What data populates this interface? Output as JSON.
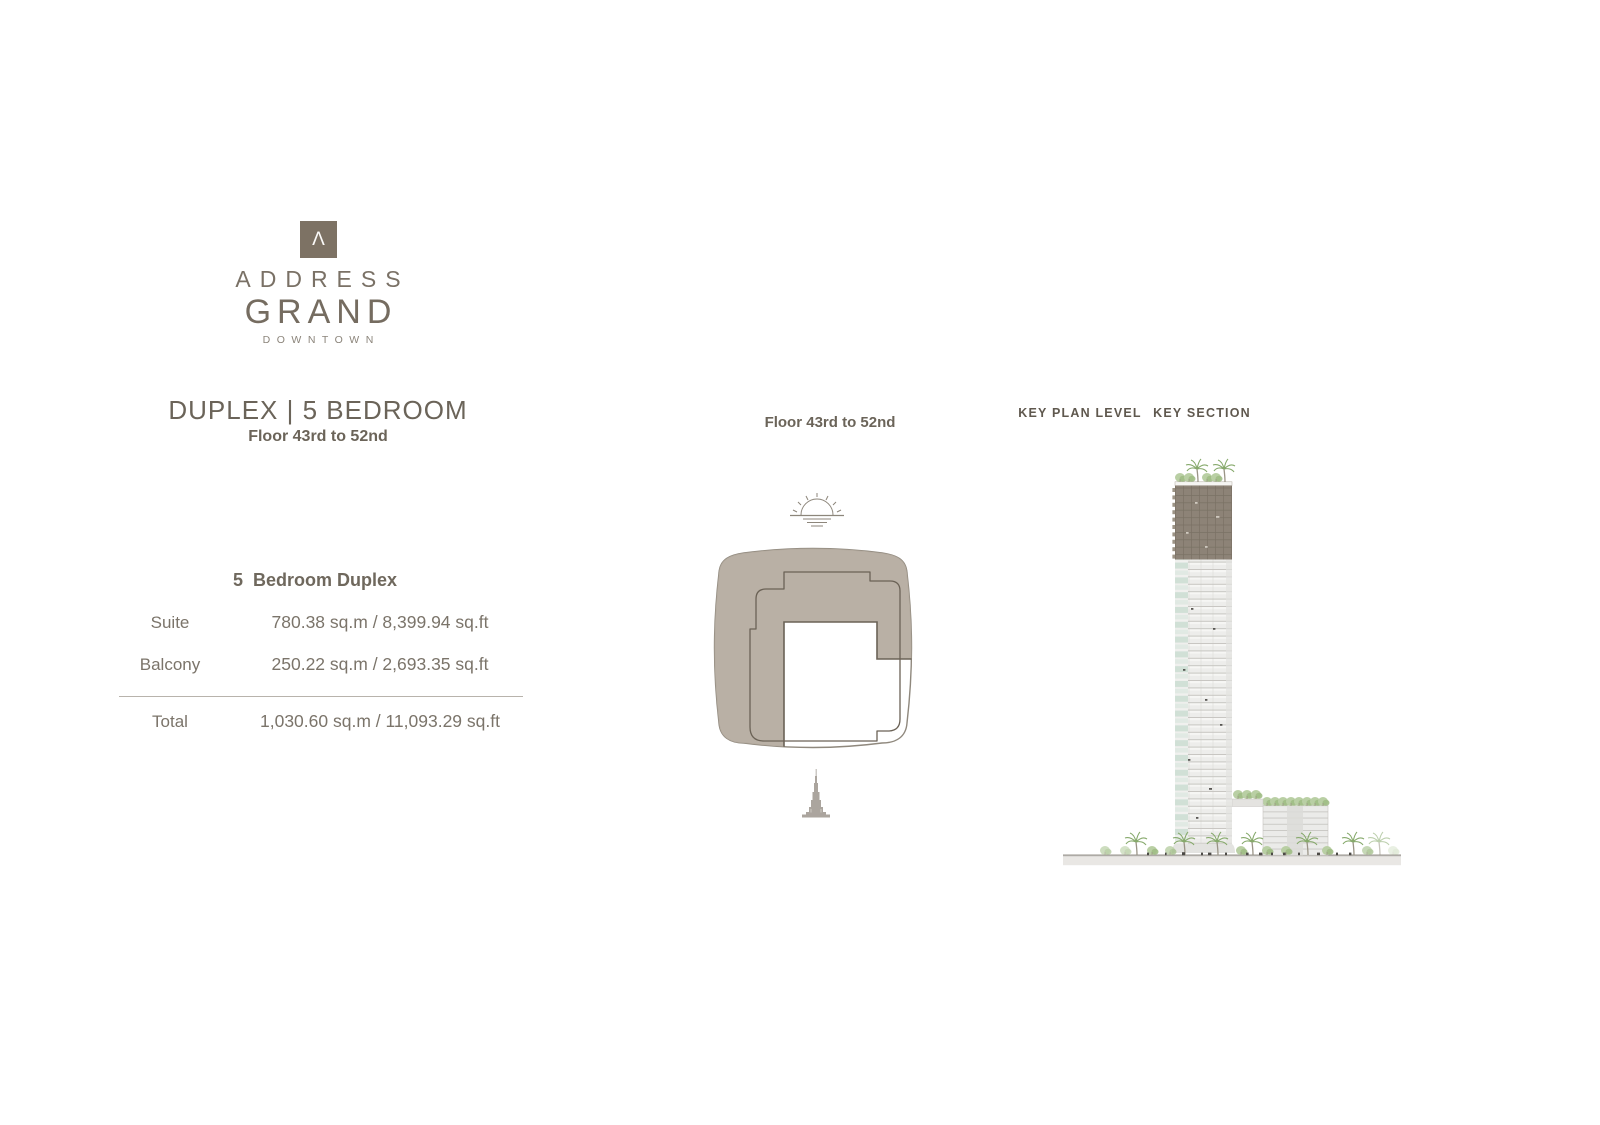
{
  "brand": {
    "mark": "Λ",
    "name_line1": "ADDRESS",
    "name_line2": "GRAND",
    "name_line3": "DOWNTOWN",
    "logo_bg": "#7d7264"
  },
  "unit": {
    "title": "DUPLEX | 5 BEDROOM",
    "floors": "Floor 43rd to 52nd"
  },
  "area_table": {
    "title": "5  Bedroom Duplex",
    "rows": [
      {
        "label": "Suite",
        "value": "780.38 sq.m / 8,399.94 sq.ft"
      },
      {
        "label": "Balcony",
        "value": "250.22 sq.m / 2,693.35 sq.ft"
      }
    ],
    "total": {
      "label": "Total",
      "value": "1,030.60 sq.m / 11,093.29 sq.ft"
    }
  },
  "key_plan": {
    "floors_label": "Floor 43rd to 52nd",
    "icons": {
      "sun": "sunrise-over-horizon",
      "landmark": "burj-khalifa",
      "plan_shape": "floor-plate-key-plan"
    }
  },
  "key_section": {
    "plan_level_label": "KEY PLAN LEVEL",
    "section_label": "KEY SECTION",
    "highlighted_floors": "43rd to 52nd (top section of tower)"
  },
  "colors": {
    "accent_taupe": "#b4aa9e",
    "highlight_outline": "#6b6256",
    "tower_highlight": "#8d8377",
    "tower_light": "#ededeb",
    "teal_glass": "#cfdfd5",
    "greenery": "#8aab6e",
    "text": "#6d665c"
  }
}
